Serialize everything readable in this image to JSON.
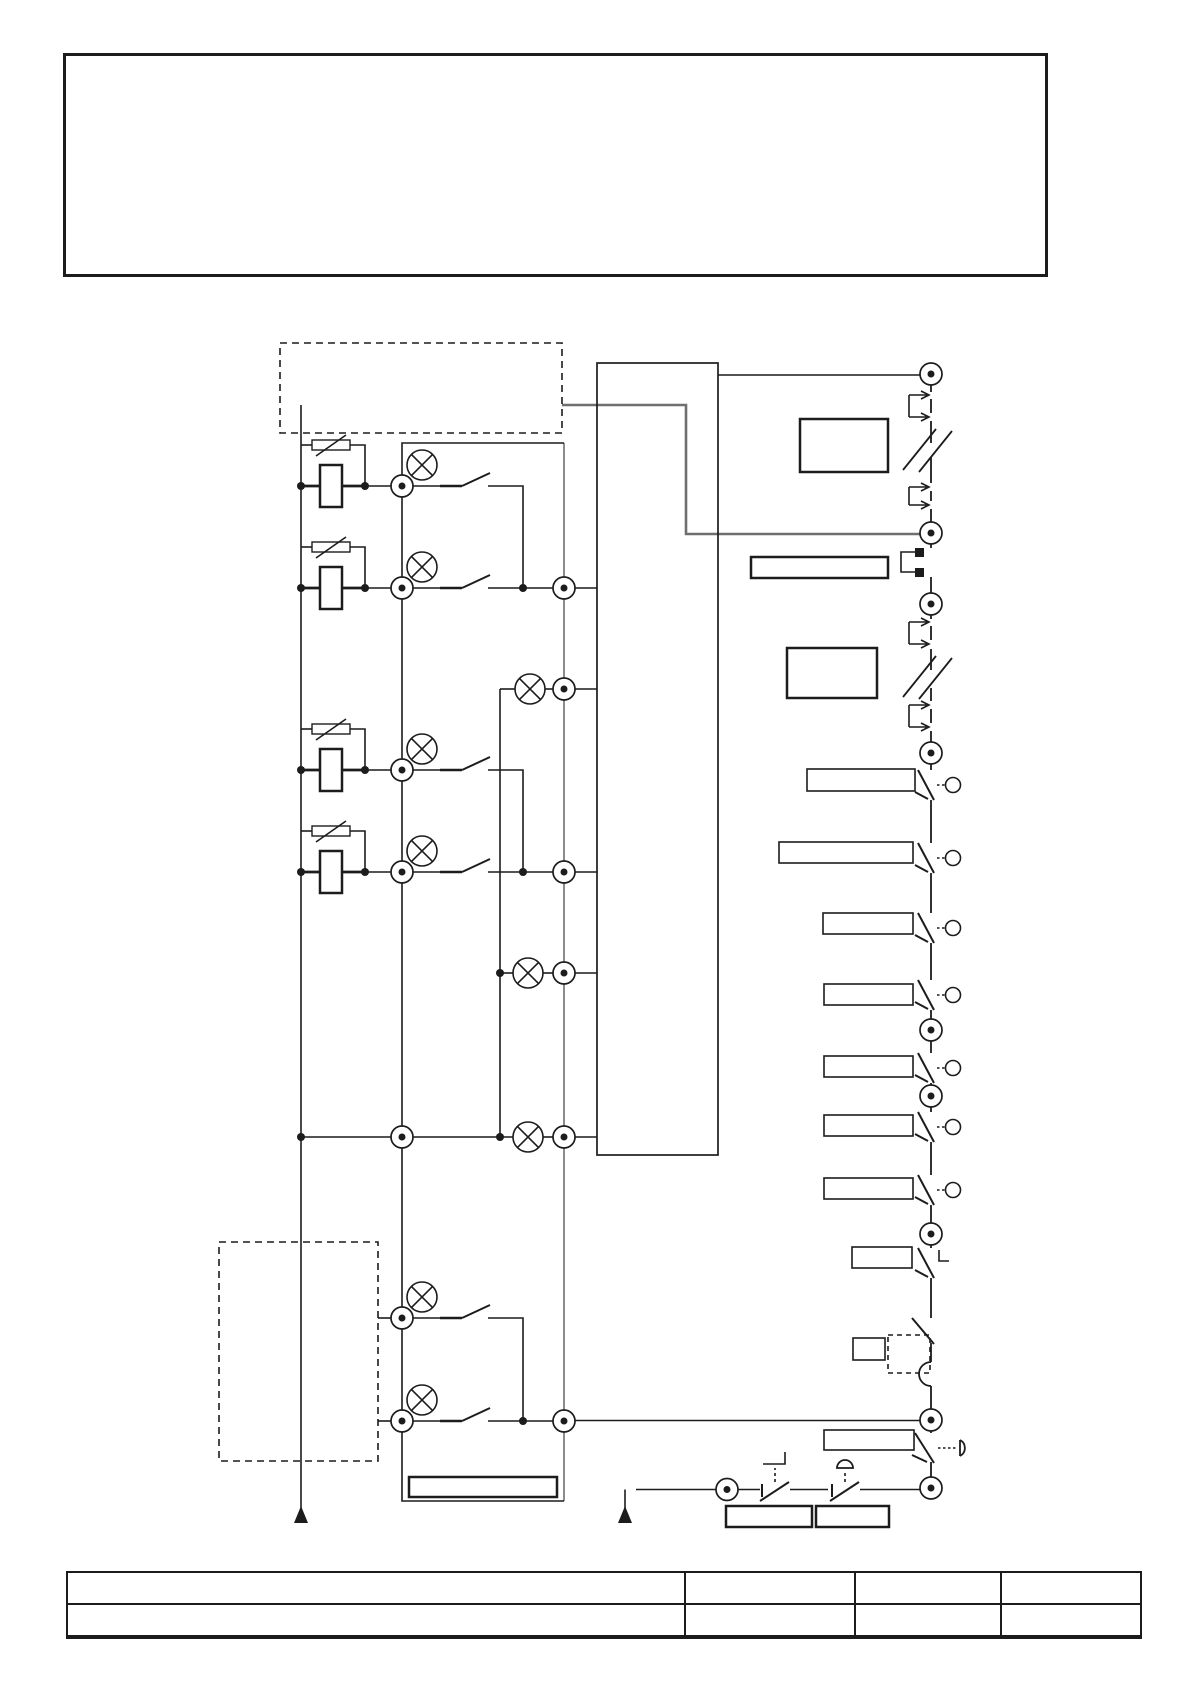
{
  "colors": {
    "ink": "#1c1c1c",
    "gray": "#6f6f6f",
    "paper": "#ffffff"
  },
  "notes_box": {
    "content": ""
  },
  "schematic": {
    "top_dashed_unit_label": "",
    "bottom_dashed_unit_label": "",
    "controller_label": "",
    "lamp_column_label": "",
    "relay_channel_count": 4,
    "indicator_lamp_count": 9,
    "terminal_count": 23,
    "right_rail_switch_labels": [
      "",
      "",
      "",
      "",
      "",
      "",
      "",
      "",
      "",
      ""
    ],
    "component_box_labels": [
      "",
      "",
      ""
    ],
    "bottom_button_labels": [
      "",
      ""
    ]
  },
  "title_block": {
    "row1": [
      "",
      "",
      "",
      ""
    ],
    "row2": [
      "",
      "",
      "",
      ""
    ]
  }
}
